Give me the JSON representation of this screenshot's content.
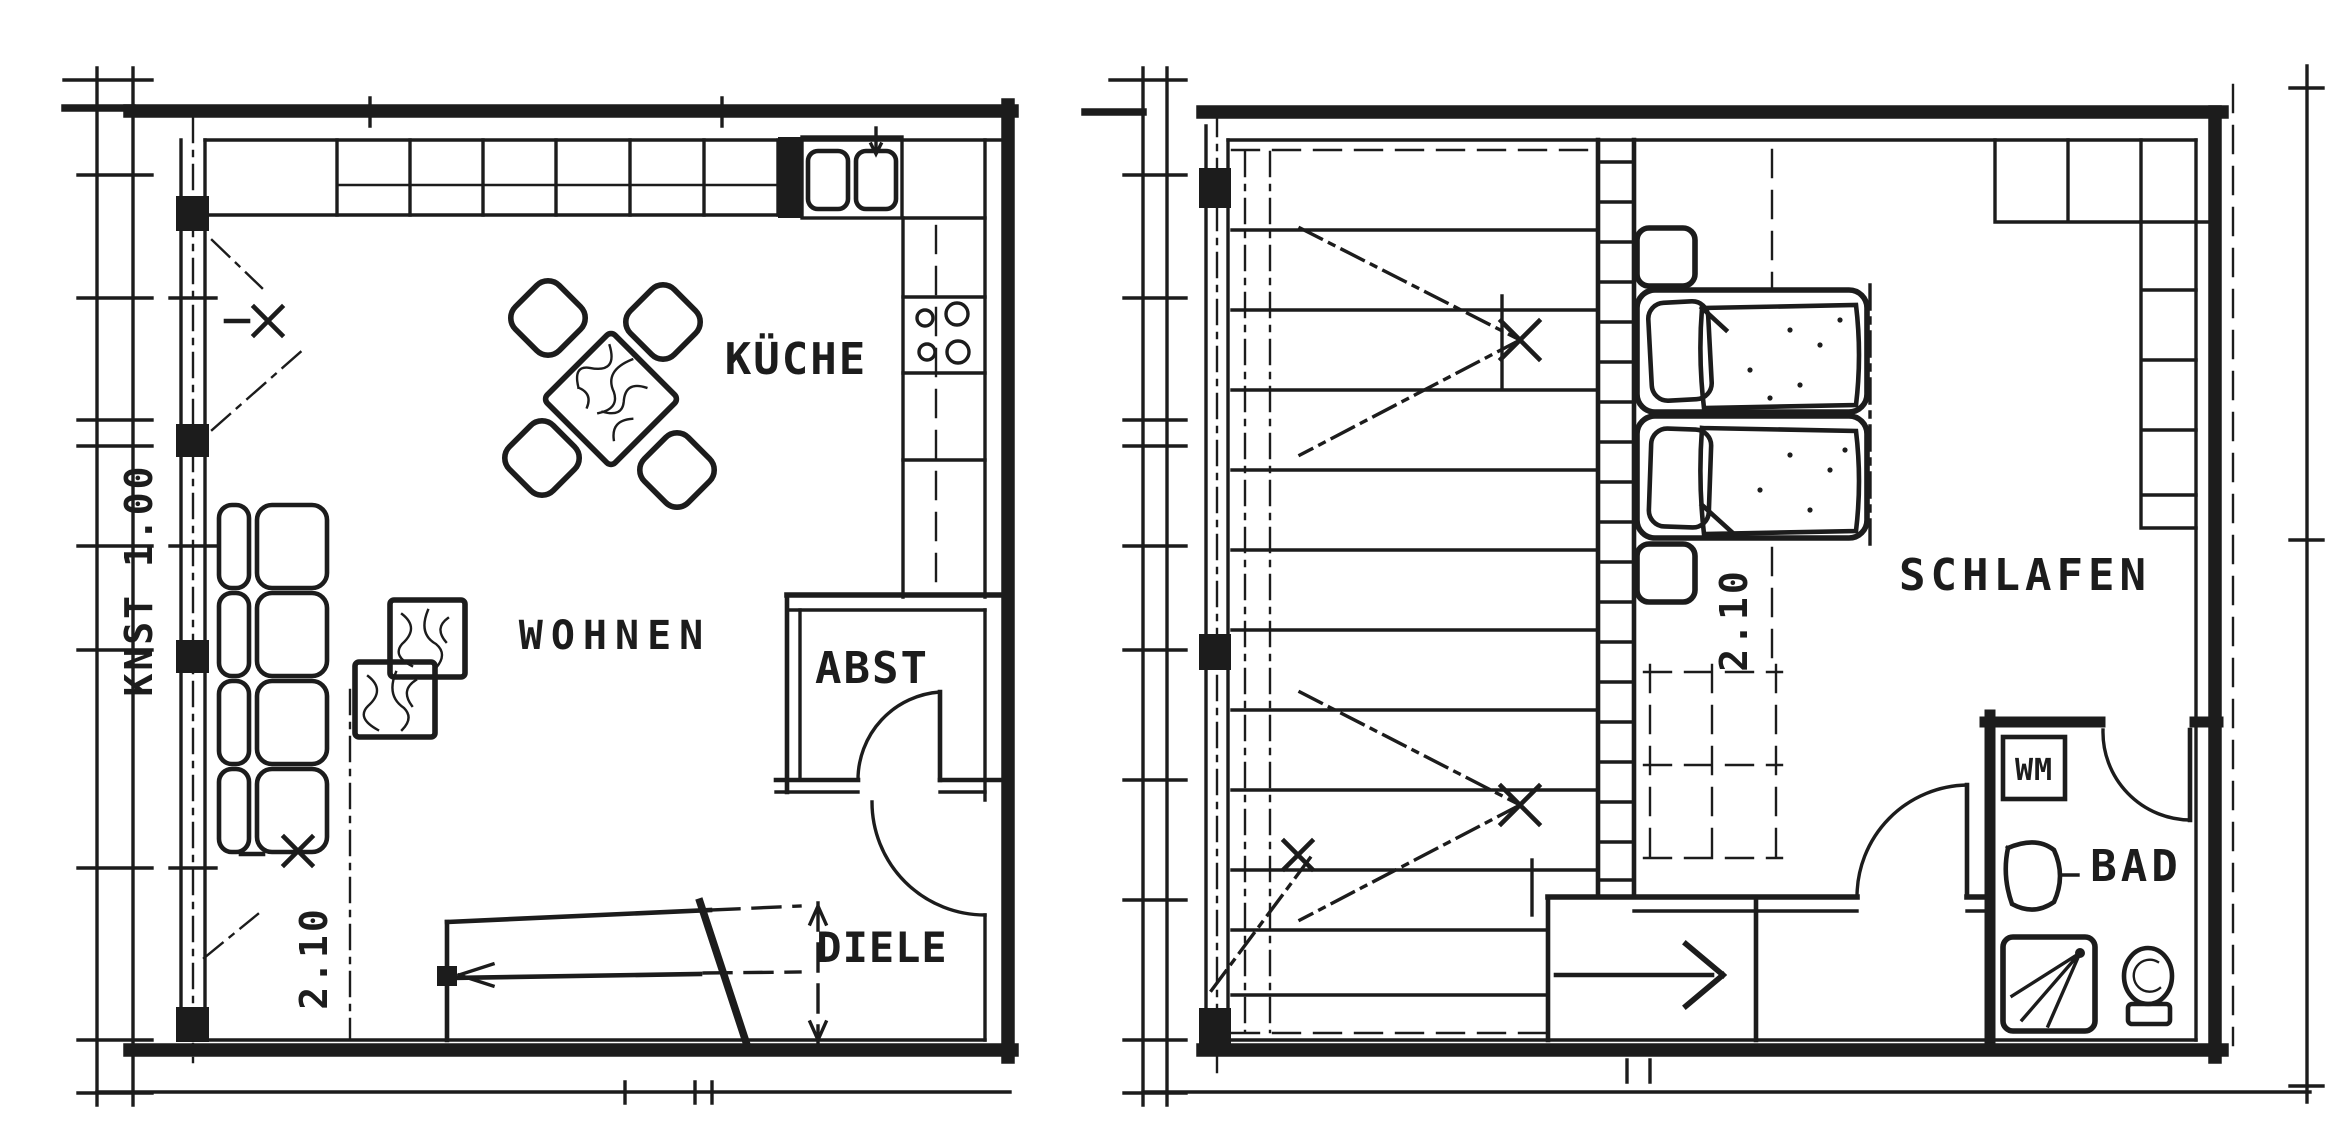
{
  "document": {
    "type": "architectural floor plan, two storeys, scanned black ink drawing",
    "background_color": "#ffffff",
    "ink_color": "#1c1c1c"
  },
  "plans": [
    {
      "name": "ground-floor",
      "rooms": [
        {
          "id": "kueche",
          "label": "KÜCHE"
        },
        {
          "id": "wohnen",
          "label": "WOHNEN"
        },
        {
          "id": "abst",
          "label": "ABST"
        },
        {
          "id": "diele",
          "label": "DIELE"
        }
      ],
      "annotations": [
        {
          "id": "knee-wall-height",
          "label": "KNST 1.00"
        },
        {
          "id": "headroom-height",
          "label": "2.10"
        }
      ]
    },
    {
      "name": "upper-floor",
      "rooms": [
        {
          "id": "schlafen",
          "label": "SCHLAFEN"
        },
        {
          "id": "bad",
          "label": "BAD"
        }
      ],
      "fixtures": [
        {
          "id": "wm",
          "label": "WM"
        }
      ],
      "annotations": [
        {
          "id": "headroom-height",
          "label": "2.10"
        }
      ]
    }
  ]
}
